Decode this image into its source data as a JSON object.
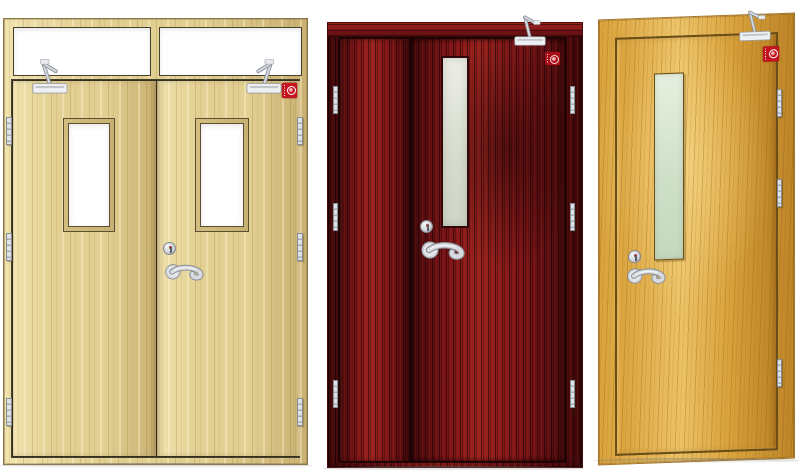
{
  "scene": {
    "type": "product-photo",
    "subject": "fire-rated wooden doors",
    "background": "#ffffff",
    "floor_shadow": "#d8d8d4"
  },
  "palette": {
    "hardware-light": "#eef0f2",
    "hardware-mid": "#d3d6db",
    "hardware-dark": "#8d939b",
    "label-red": "#c3141f",
    "label-red-deep": "#a80f18"
  },
  "doors": [
    {
      "name": "double-leaf door with transom windows, light beech",
      "wood-base": "#e2cf92",
      "wood-light": "#f0e2ae",
      "wood-streak": "#c9b172",
      "line": "#46402e",
      "glass": "#ffffff",
      "transom_windows": 2,
      "leaves": 2,
      "vision_panels": 2,
      "door_closers": 2,
      "fire_labels": 1,
      "hinges": 6
    },
    {
      "name": "unequal double-leaf door, dark mahogany",
      "wood-base": "#7f1517",
      "wood-light": "#9c241f",
      "wood-streak": "#450a0c",
      "line": "#2a0607",
      "glass": "#e3e6de",
      "transom_windows": 0,
      "leaves": 2,
      "vision_panels": 1,
      "door_closers": 1,
      "fire_labels": 1,
      "hinges": 6
    },
    {
      "name": "single-leaf door, golden oak",
      "wood-base": "#d9a23c",
      "wood-light": "#ecc266",
      "wood-streak": "#bc8427",
      "line": "#6b4e16",
      "glass": "#d9e7d3",
      "transom_windows": 0,
      "leaves": 1,
      "vision_panels": 1,
      "door_closers": 1,
      "fire_labels": 1,
      "hinges": 3
    }
  ],
  "icons": {
    "door_closer": "door-closer-icon",
    "fire_label": "fire-rating-label-icon",
    "lever_handle": "lever-handle-icon",
    "lock_cylinder": "lock-cylinder-icon",
    "hinge": "hinge-icon"
  }
}
